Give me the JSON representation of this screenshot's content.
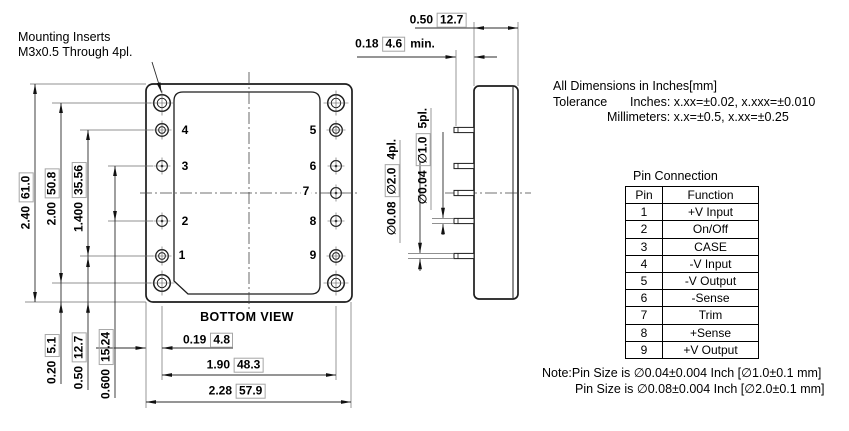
{
  "drawing": {
    "mounting_note": {
      "line1": "Mounting Inserts",
      "line2": "M3x0.5 Through 4pl."
    },
    "view_label": "BOTTOM VIEW",
    "pin_numbers": {
      "left": [
        "4",
        "3",
        "2",
        "1"
      ],
      "right": [
        "5",
        "6",
        "7",
        "8",
        "9"
      ]
    },
    "dims": {
      "overall_height": {
        "inch": "2.40",
        "mm": "61.0"
      },
      "mount_hole_span": {
        "inch": "2.00",
        "mm": "50.8"
      },
      "pin_row_span": {
        "inch": "1.400",
        "mm": "35.56"
      },
      "pin_row_inner": {
        "inch": "0.600",
        "mm": "15.24"
      },
      "pin_row_offset": {
        "inch": "0.50",
        "mm": "12.7"
      },
      "mount_hole_offset": {
        "inch": "0.20",
        "mm": "5.1"
      },
      "edge_to_pin_col": {
        "inch": "0.19",
        "mm": "4.8"
      },
      "pin_col_span": {
        "inch": "1.90",
        "mm": "48.3"
      },
      "overall_width": {
        "inch": "2.28",
        "mm": "57.9"
      },
      "case_depth": {
        "inch": "0.50",
        "mm": "12.7"
      },
      "pin_standoff": {
        "inch": "0.18",
        "mm": "4.6",
        "suffix": "min."
      },
      "pin_dia_large": {
        "inch": "∅0.08",
        "mm": "∅2.0",
        "suffix": "4pl."
      },
      "pin_dia_small": {
        "inch": "∅0.04",
        "mm": "∅1.0",
        "suffix": "5pl."
      }
    }
  },
  "tolerance_block": {
    "heading": "All Dimensions in Inches[mm]",
    "label": "Tolerance",
    "inches": "Inches: x.xx=±0.02, x.xxx=±0.010",
    "millimeters": "Millimeters: x.x=±0.5, x.xx=±0.25"
  },
  "pin_table": {
    "title": "Pin Connection",
    "headers": [
      "Pin",
      "Function"
    ],
    "rows": [
      [
        "1",
        "+V Input"
      ],
      [
        "2",
        "On/Off"
      ],
      [
        "3",
        "CASE"
      ],
      [
        "4",
        "-V Input"
      ],
      [
        "5",
        "-V Output"
      ],
      [
        "6",
        "-Sense"
      ],
      [
        "7",
        "Trim"
      ],
      [
        "8",
        "+Sense"
      ],
      [
        "9",
        "+V Output"
      ]
    ]
  },
  "notes": {
    "line1": "Note:Pin Size is ∅0.04±0.004 Inch [∅1.0±0.1 mm]",
    "line2": "Pin Size is ∅0.08±0.004 Inch [∅2.0±0.1 mm]"
  }
}
